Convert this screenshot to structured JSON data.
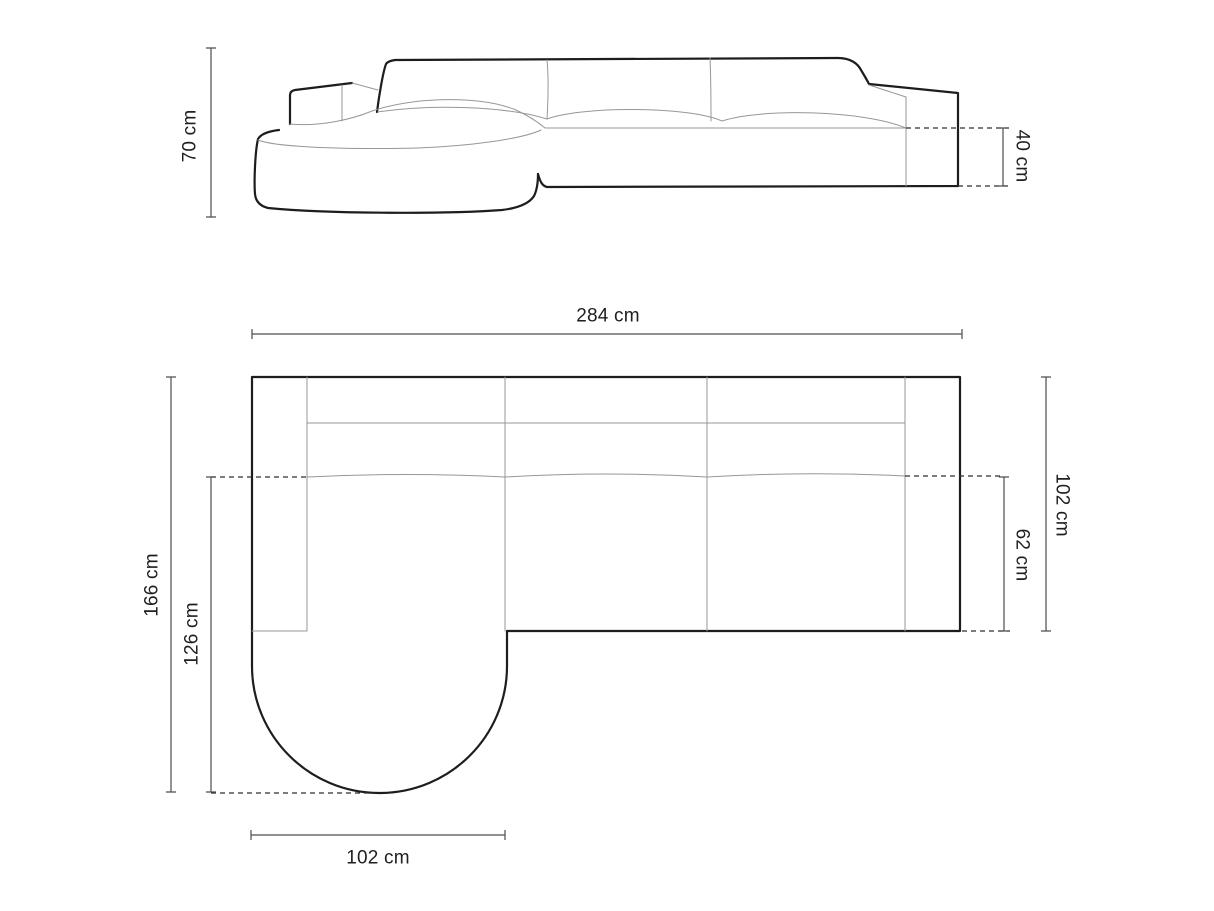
{
  "diagram": {
    "type": "furniture-dimension-drawing",
    "subject": "corner sofa with rounded chaise longue",
    "views": {
      "front_elevation": {
        "dimensions": {
          "overall_height": "70 cm",
          "seat_height": "40 cm"
        }
      },
      "top_plan": {
        "dimensions": {
          "overall_width": "284 cm",
          "overall_depth_right": "102 cm",
          "seat_depth_right": "62 cm",
          "chaise_total_length": "166 cm",
          "chaise_protrusion_length": "126 cm",
          "chaise_width": "102 cm"
        }
      }
    },
    "colors": {
      "outline": "#1d1d1d",
      "seam_line": "#979797",
      "dimension_line": "#4d4d4d",
      "dashed_line": "#2e2e2e",
      "label_text": "#1f1f1f",
      "background": "#ffffff"
    }
  }
}
